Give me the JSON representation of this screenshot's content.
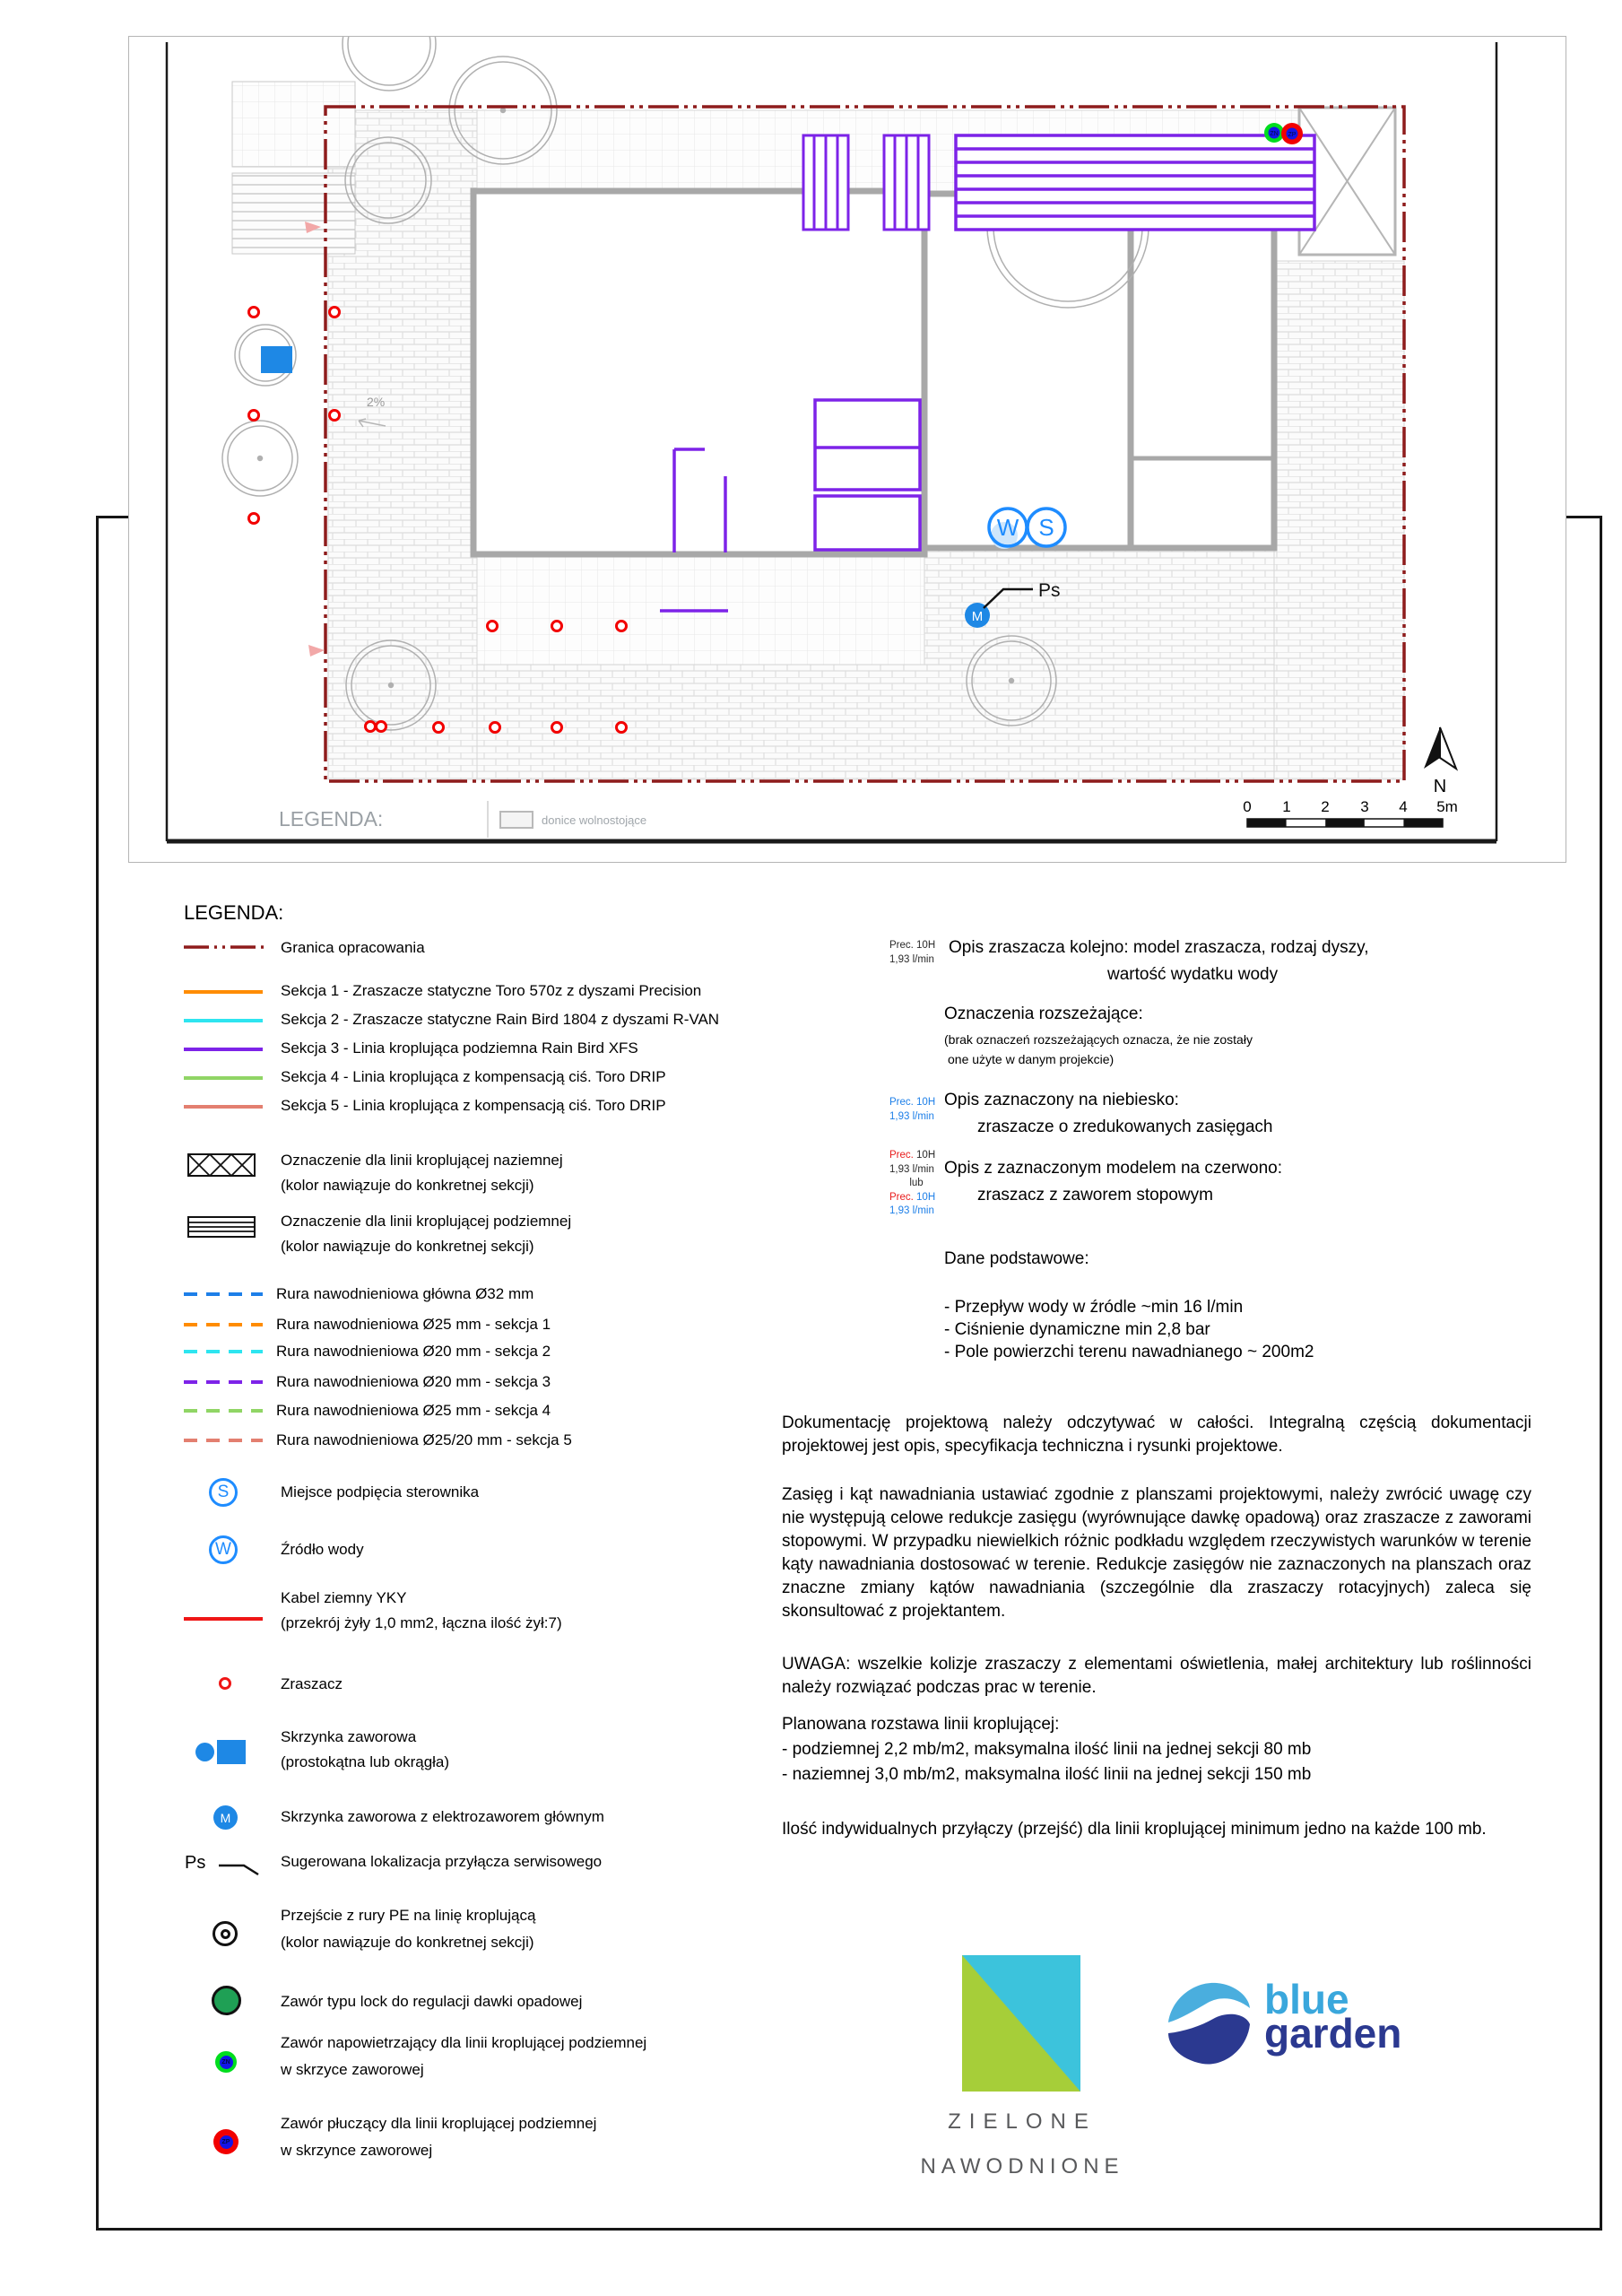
{
  "plan": {
    "strip_title": "LEGENDA:",
    "donice_label": "donice wolnostojące",
    "slope_label": "2%",
    "ps_label": "Ps",
    "north_label": "N",
    "markers": {
      "water": "W",
      "controller": "S",
      "master": "M",
      "zn": "ZN",
      "zp": "ZP"
    },
    "scale_labels": [
      "0",
      "1",
      "2",
      "3",
      "4",
      "5m"
    ]
  },
  "legend": {
    "title": "LEGENDA:",
    "sym": {
      "s": "S",
      "w": "W",
      "m": "M",
      "zn": "ZN",
      "zp": "ZP",
      "ps": "Ps"
    },
    "items": [
      {
        "label": "Granica opracowania"
      },
      {
        "label": "Sekcja 1 - Zraszacze statyczne Toro 570z  z dyszami Precision"
      },
      {
        "label": "Sekcja 2 - Zraszacze statyczne Rain Bird 1804 z dyszami R-VAN"
      },
      {
        "label": "Sekcja 3 - Linia kroplująca podziemna Rain Bird XFS"
      },
      {
        "label": "Sekcja 4 - Linia kroplująca z kompensacją ciś. Toro DRIP"
      },
      {
        "label": "Sekcja 5 - Linia kroplująca z kompensacją ciś. Toro DRIP"
      },
      {
        "label": "Oznaczenie dla linii kroplującej naziemnej",
        "sub": "(kolor nawiązuje do konkretnej sekcji)"
      },
      {
        "label": "Oznaczenie dla linii kroplującej podziemnej",
        "sub": "(kolor nawiązuje do konkretnej sekcji)"
      },
      {
        "label": "Rura nawodnieniowa główna Ø32 mm"
      },
      {
        "label": "Rura nawodnieniowa Ø25 mm - sekcja 1"
      },
      {
        "label": "Rura nawodnieniowa Ø20 mm - sekcja 2"
      },
      {
        "label": "Rura nawodnieniowa Ø20 mm - sekcja 3"
      },
      {
        "label": "Rura nawodnieniowa Ø25 mm - sekcja 4"
      },
      {
        "label": "Rura nawodnieniowa Ø25/20 mm - sekcja 5"
      },
      {
        "label": "Miejsce podpięcia sterownika"
      },
      {
        "label": "Źródło wody"
      },
      {
        "label": "Kabel ziemny YKY",
        "sub": "(przekrój żyły 1,0 mm2, łączna ilość żył:7)"
      },
      {
        "label": "Zraszacz"
      },
      {
        "label": "Skrzynka zaworowa",
        "sub": "(prostokątna lub okrągła)"
      },
      {
        "label": "Skrzynka zaworowa z elektrozaworem głównym"
      },
      {
        "label": "Sugerowana lokalizacja przyłącza serwisowego"
      },
      {
        "label": "Przejście z rury PE na linię kroplującą",
        "sub": "(kolor nawiązuje do konkretnej sekcji)"
      },
      {
        "label": "Zawór typu lock do regulacji dawki opadowej"
      },
      {
        "label": "Zawór napowietrzający dla linii kroplującej podziemnej",
        "sub": "w skrzyce zaworowej"
      },
      {
        "label": "Zawór płuczący dla linii kroplującej podziemnej",
        "sub": "w skrzynce zaworowej"
      }
    ]
  },
  "notes": {
    "ann_top": {
      "l1": "Prec. 10H",
      "l2": "1,93 l/min"
    },
    "opis1": {
      "l1": "Opis zraszacza kolejno:  model zraszacza, rodzaj dyszy,",
      "l2": "wartość wydatku wody"
    },
    "rozsz": {
      "title": "Oznaczenia rozszeżające:",
      "s1": "(brak oznaczeń rozszeżających oznacza, że nie zostały",
      "s2": " one użyte w danym projekcie)"
    },
    "ann_blue": {
      "l1": "Prec. 10H",
      "l2": "1,93 l/min"
    },
    "opis_nieb": {
      "l1": "Opis zaznaczony na niebiesko:",
      "l2": "zraszacze o zredukowanych zasięgach"
    },
    "ann_mix": {
      "l1a": "Prec.",
      "l1b": " 10H",
      "l2": "1,93 l/min",
      "l3": "lub",
      "l4a": "Prec.",
      "l4b": " 10H",
      "l5": "1,93 l/min"
    },
    "opis_czerw": {
      "l1": "Opis z zaznaczonym modelem na czerwono:",
      "l2": "zraszacz z zaworem stopowym"
    },
    "dane": {
      "title": "Dane podstawowe:",
      "i1": "- Przepływ wody w źródle ~min 16 l/min",
      "i2": "- Ciśnienie dynamiczne min 2,8 bar",
      "i3": "- Pole powierzchi terenu nawadnianego ~ 200m2"
    },
    "par1": "Dokumentację projektową należy odczytywać w całości. Integralną częścią dokumentacji projektowej jest opis, specyfikacja techniczna i rysunki projektowe.",
    "par2": "Zasięg i kąt nawadniania ustawiać zgodnie z planszami projektowymi, należy zwrócić uwagę czy nie występują celowe redukcje zasięgu (wyrównujące dawkę opadową) oraz zraszacze z zaworami stopowymi. W przypadku niewielkich różnic podkładu względem rzeczywistych warunków w terenie kąty nawadniania dostosować w terenie. Redukcje zasięgów nie zaznaczonych na planszach oraz znaczne zmiany kątów nawadniania (szczególnie dla zraszaczy rotacyjnych) zaleca się skonsultować z projektantem.",
    "par3": "UWAGA: wszelkie kolizje zraszaczy z elementami oświetlenia, małej architektury lub roślinności należy rozwiązać podczas prac w terenie.",
    "rozstawa": {
      "title": "Planowana rozstawa linii kroplującej:",
      "i1": "- podziemnej 2,2 mb/m2, maksymalna ilość linii na jednej sekcji 80 mb",
      "i2": "- naziemnej 3,0 mb/m2, maksymalna ilość linii na jednej sekcji 150 mb"
    },
    "par4": "Ilość indywidualnych przyłączy (przejść) dla linii kroplującej minimum jedno na każde 100 mb."
  },
  "logos": {
    "zielone": {
      "l1": "ZIELONE",
      "l2": "NAWODNIONE"
    },
    "bluegarden": {
      "w1": "blue",
      "w2": "garden"
    }
  },
  "colors": {
    "boundary": "#8e1c1c",
    "sekcja1": "#ff8c00",
    "sekcja2": "#2ee5f0",
    "sekcja3": "#7d23e8",
    "sekcja4": "#90d565",
    "sekcja5": "#e37f70",
    "main_pipe": "#1d7fe8",
    "marker_blue": "#1e8cff",
    "valve_fill": "#1e88e5",
    "red": "#f20000",
    "lock_green": "#1fa055",
    "zn_green": "#00dd1e",
    "inner_blue": "#1414e8",
    "zielone_green": "#a6ce39",
    "zielone_cyan": "#3cc3dc",
    "blue_word": "#3aa7dc",
    "garden_word": "#2b3990"
  }
}
